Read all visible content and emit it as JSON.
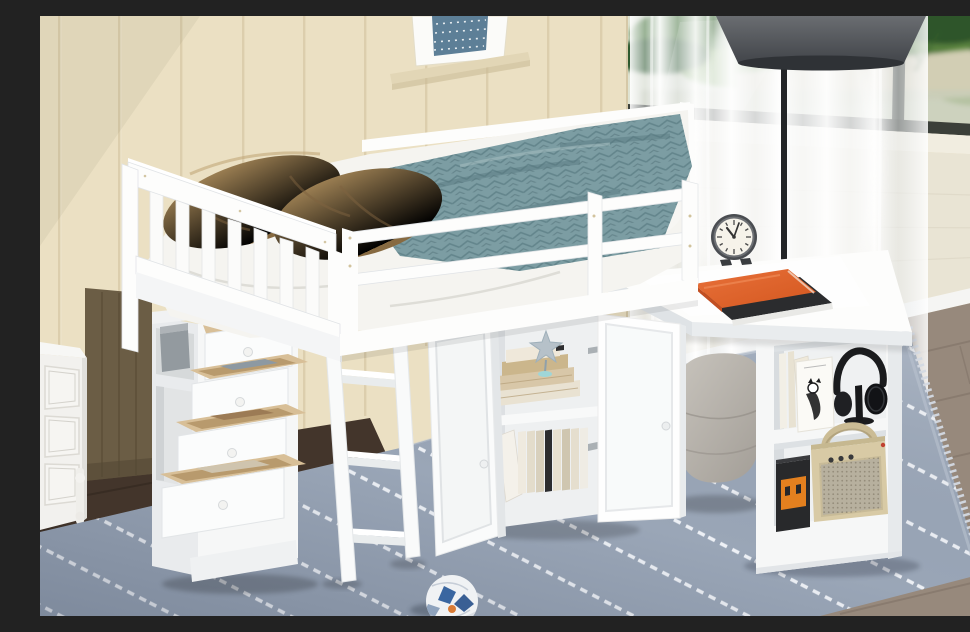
{
  "meta": {
    "kind": "furniture product photograph",
    "width": 970,
    "height": 600
  },
  "scene": {
    "description": "White twin loft bed with storage: four open drawers with wooden boxes, open two-door cabinet full of books, attached white desk with retro alarm clock and orange notebook, ladder, and side bookcase holding picture books, headphones on a stand, a toy robot and a cream portable speaker. Room has beige paneled walls, framed art on a ledge, a window with sheer curtains and greenery, a black floor lamp, a gray pouf, a white nightstand, dark wardrobe, blue striped rug and a soccer ball.",
    "objects": [
      "beige paneled wall",
      "framed wall art",
      "display ledge",
      "window with garden view",
      "sheer white curtains",
      "black floor lamp",
      "white loft bed frame",
      "slatted headboard",
      "safety guard rail",
      "brown throw pillows",
      "white duvet",
      "teal herringbone blanket",
      "white ladder",
      "four-drawer storage chest",
      "gray storage box in c ubby",
      "storage cabinet with open doors",
      "shelved books",
      "silver starfish ornament",
      "attached white desk",
      "retro alarm clock",
      "orange notebook on black book",
      "two-shelf side bookcase",
      "cartoon picture book",
      "black headphones on stand",
      "toy robot",
      "cream portable speaker",
      "gray tufted pouf",
      "blue striped area rug",
      "white nightstand",
      "dark wood wardrobe",
      "soccer ball",
      "wood flooring"
    ]
  },
  "palette": {
    "wall": "#ebe0c3",
    "wallGroove": "#d0c19c",
    "artBlue": "#5d7f97",
    "ledge": "#e2d6b6",
    "windowFrame": "#3b3f39",
    "planter": "#d8d1bb",
    "bench": "#e9e4d4",
    "floorRight": "#97897c",
    "floorLeft": "#43352b",
    "wardrobe": "#6b5d45",
    "lampPole": "#232527",
    "lampShade": "#5a5d61",
    "white": "#fdfdfc",
    "whiteSoft": "#f4f5f6",
    "whiteShade": "#e4e7ea",
    "duvet": "#f5f4f0",
    "teal": "#7c9da3",
    "tealDark": "#4f7078",
    "pillow": "#a3855c",
    "pillowDark": "#7f6340",
    "wood": "#d8bf97",
    "rug": "#9aa6b7",
    "rugStripe": "#eef1f6",
    "rugFringe": "#d4dae3",
    "pouf": "#bcb8b1",
    "orange": "#dd6330",
    "bookBlack": "#2b2c2e",
    "clockFace": "#f6f3ea",
    "clockRim": "#4a4d51",
    "headphoneBlack": "#1b1c1e",
    "speakerCream": "#d8caa5",
    "speakerGrille": "#b7b09e",
    "robotBlack": "#28292b",
    "robotOrange": "#e3801f",
    "silver": "#b6c1c9",
    "boxGray": "#939a9f",
    "ballBlue": "#3a66a0",
    "ballOrange": "#d97b35"
  }
}
